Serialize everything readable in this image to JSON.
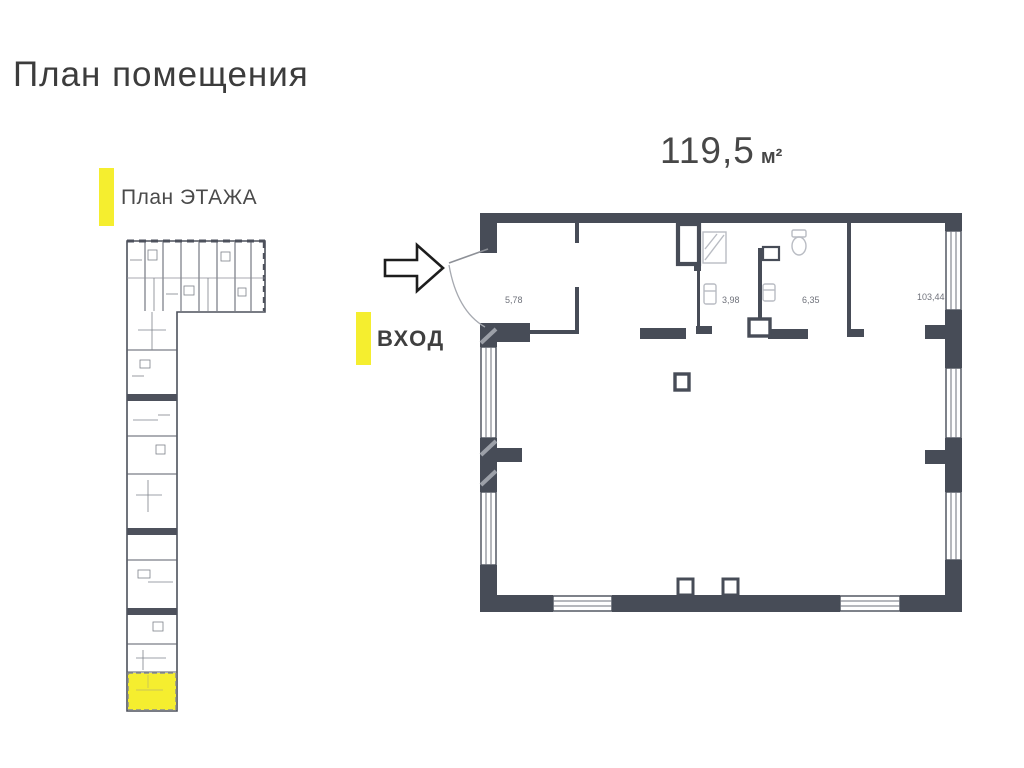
{
  "title": "План помещения",
  "overview": {
    "label": "План ЭТАЖА"
  },
  "entrance": {
    "label": "ВХОД"
  },
  "unit": {
    "area_value": "119,5",
    "area_unit": "м²",
    "rooms": [
      {
        "id": "vestibule",
        "area": "5,78"
      },
      {
        "id": "bathroom",
        "area": "3,98"
      },
      {
        "id": "wc",
        "area": "6,35"
      },
      {
        "id": "main-hall",
        "area": "103,44"
      }
    ]
  },
  "colors": {
    "wall": "#474c57",
    "hatch": "#9ca0a8",
    "fixture": "#b9bcc3",
    "highlight": "#f5ee2f",
    "text": "#3c3c3c"
  }
}
